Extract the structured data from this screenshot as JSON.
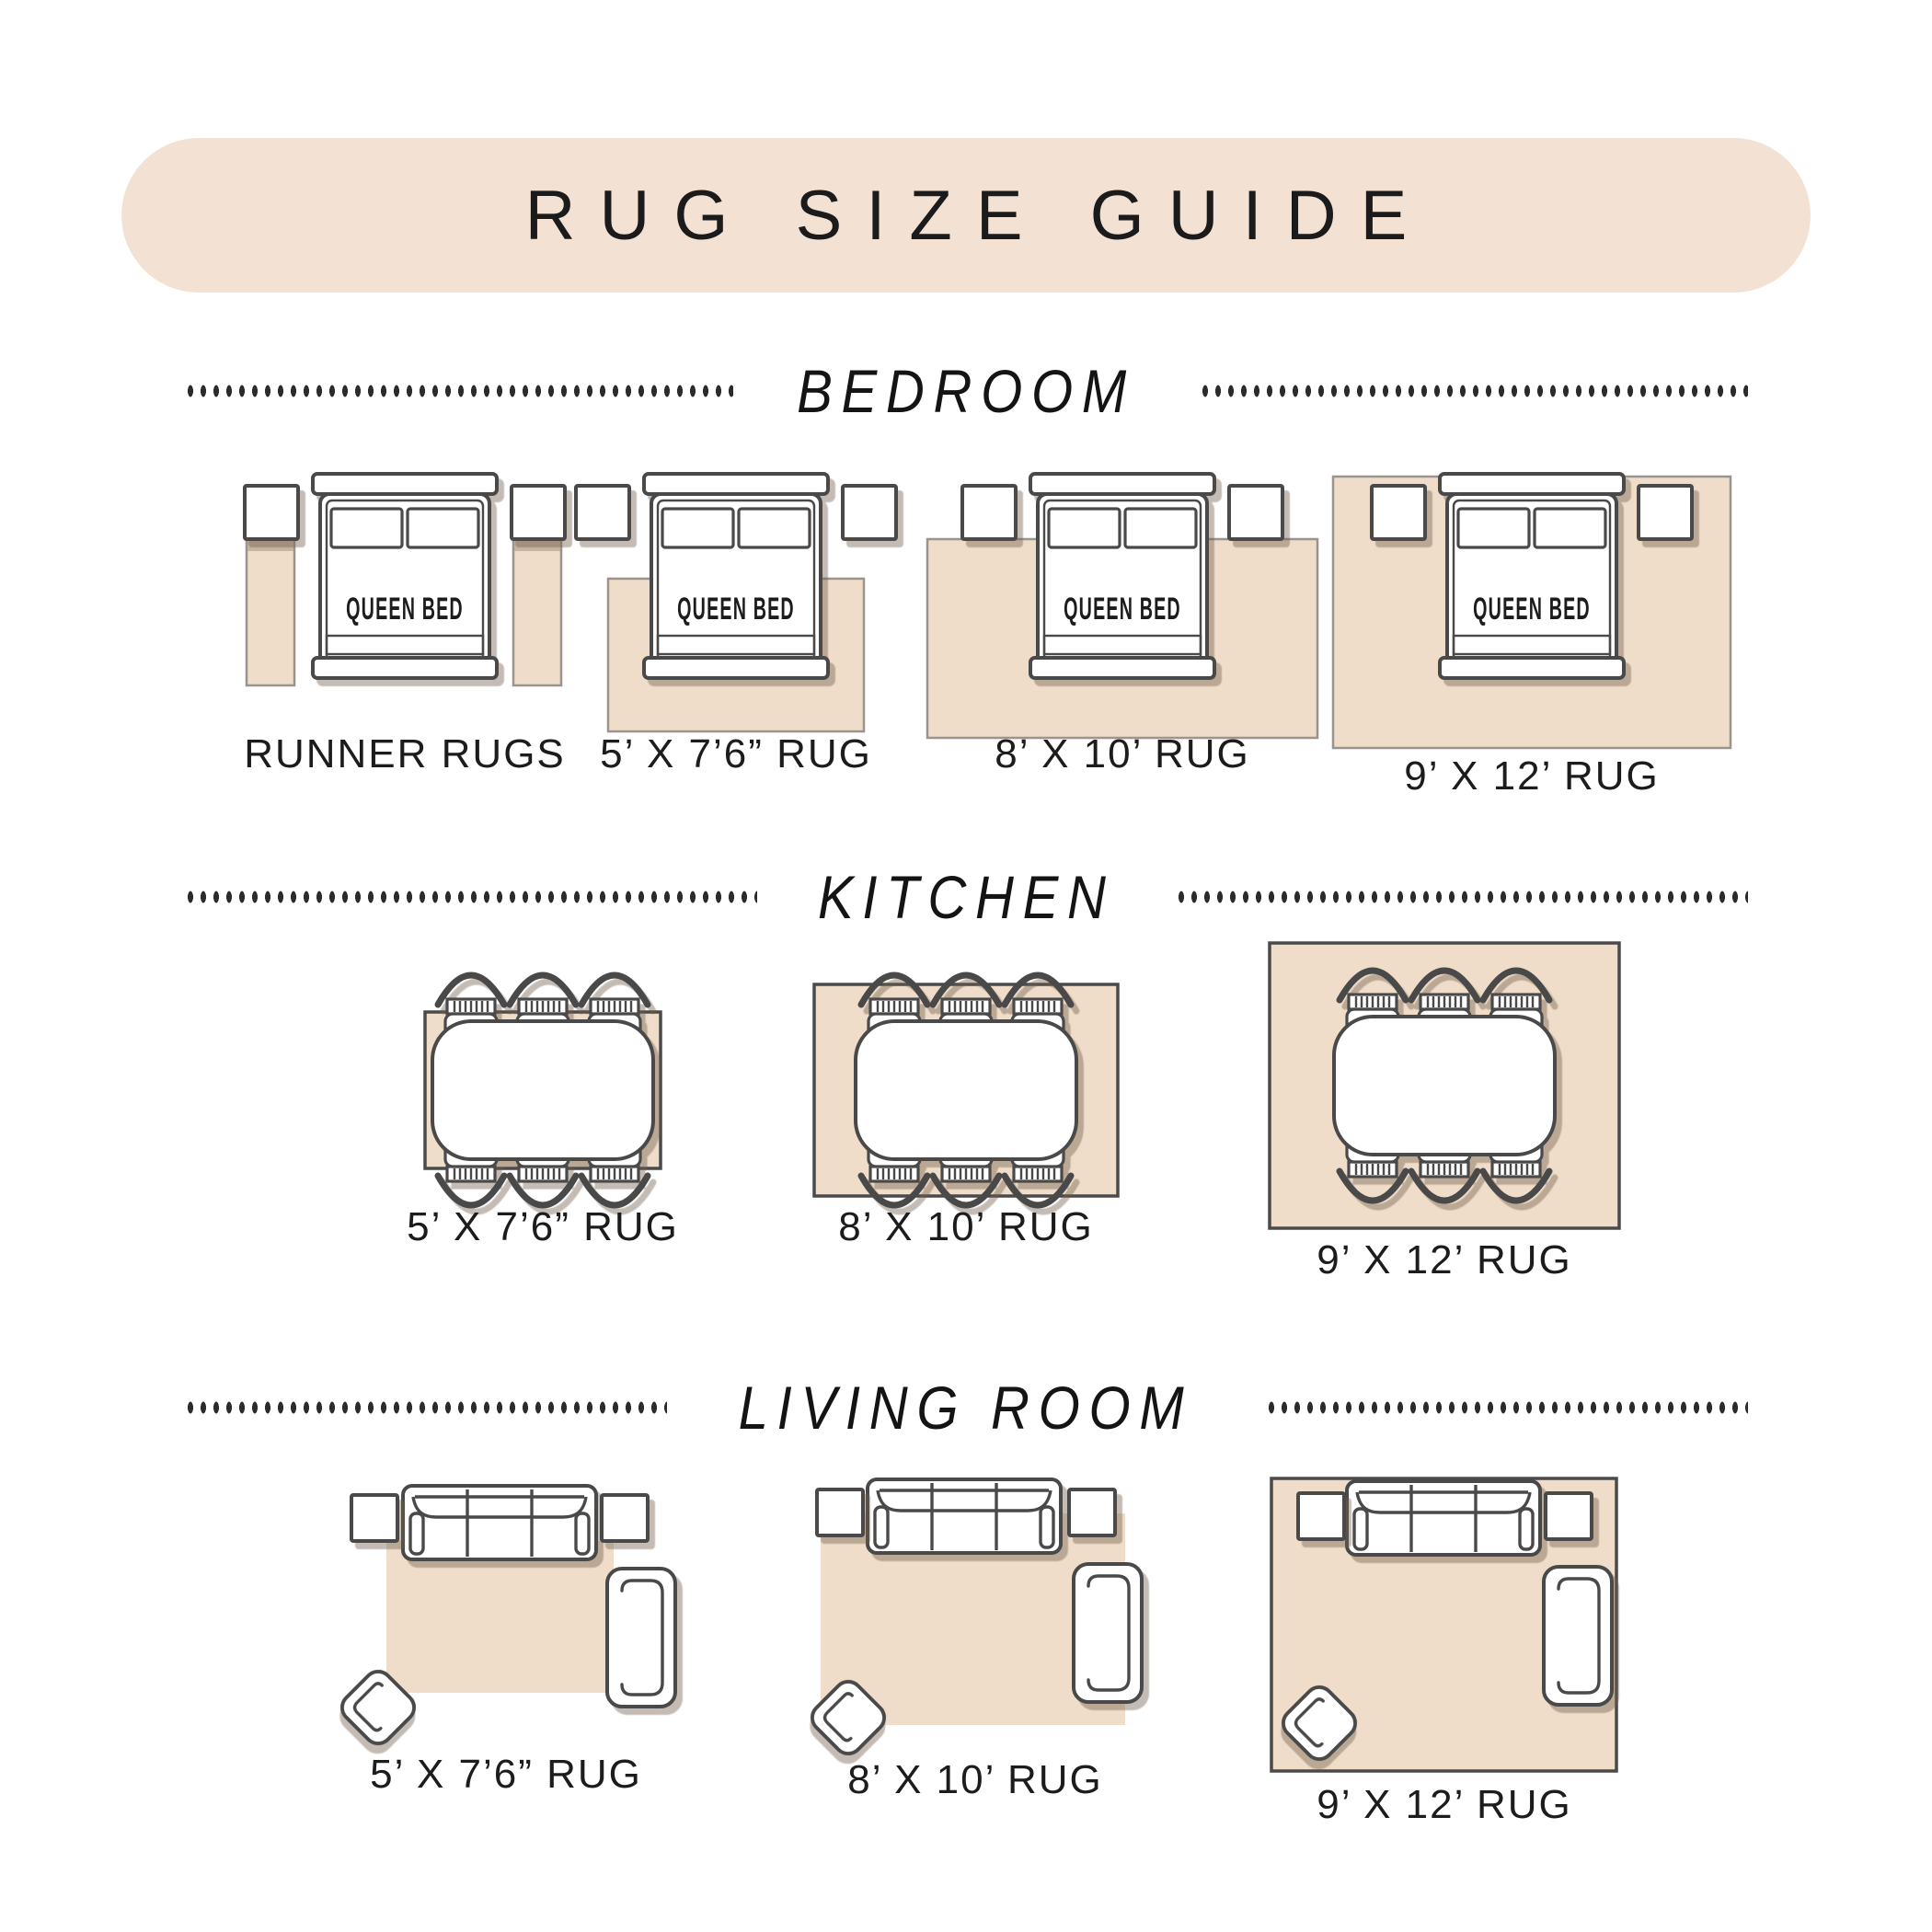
{
  "page": {
    "title": "RUG SIZE GUIDE"
  },
  "bed": {
    "label": "QUEEN BED"
  },
  "sections": [
    {
      "name": "BEDROOM",
      "items": [
        {
          "label": "RUNNER RUGS"
        },
        {
          "label": "5’ X 7’6” RUG"
        },
        {
          "label": "8’ X 10’ RUG"
        },
        {
          "label": "9’ X 12’ RUG"
        }
      ]
    },
    {
      "name": "KITCHEN",
      "items": [
        {
          "label": "5’ X 7’6” RUG"
        },
        {
          "label": "8’ X 10’ RUG"
        },
        {
          "label": "9’ X 12’ RUG"
        }
      ]
    },
    {
      "name": "LIVING ROOM",
      "items": [
        {
          "label": "5’ X 7’6” RUG"
        },
        {
          "label": "8’ X 10’ RUG"
        },
        {
          "label": "9’ X 12’ RUG"
        }
      ]
    }
  ],
  "colors": {
    "banner_bg": "#f3e2d3",
    "rug_fill": "#f0ddc9",
    "outline": "#4a4a4a",
    "text": "#1a1a1a"
  }
}
